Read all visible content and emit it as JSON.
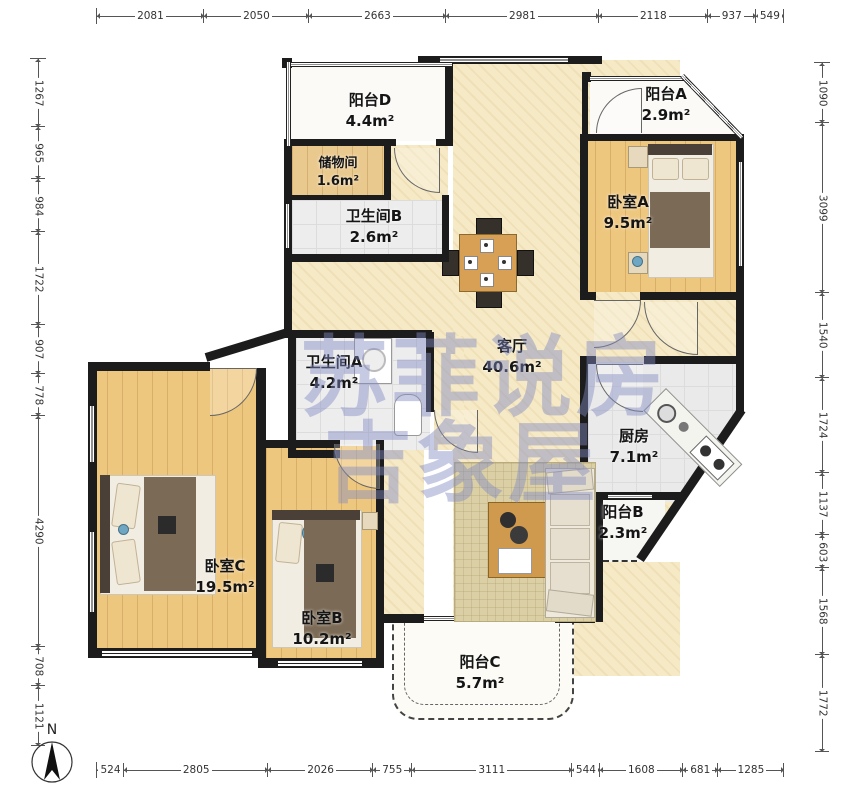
{
  "watermark": {
    "line1": "苏菲说房",
    "line2": "吉象屋"
  },
  "compass": {
    "label": "N"
  },
  "dimensions": {
    "top": [
      2081,
      2050,
      2663,
      2981,
      2118,
      937,
      549
    ],
    "bottom": [
      524,
      2805,
      2026,
      755,
      3111,
      544,
      1608,
      681,
      1285
    ],
    "left": [
      1267,
      965,
      984,
      1722,
      907,
      778,
      4290,
      708,
      1121
    ],
    "right": [
      1090,
      3099,
      1540,
      1724,
      1137,
      603,
      1568,
      1772
    ]
  },
  "rooms": {
    "balcony_d": {
      "name": "阳台D",
      "area": "4.4m²"
    },
    "storage": {
      "name": "储物间",
      "area": "1.6m²"
    },
    "bathroom_b": {
      "name": "卫生间B",
      "area": "2.6m²"
    },
    "balcony_a": {
      "name": "阳台A",
      "area": "2.9m²"
    },
    "bedroom_a": {
      "name": "卧室A",
      "area": "9.5m²"
    },
    "living_room": {
      "name": "客厅",
      "area": "40.6m²"
    },
    "bathroom_a": {
      "name": "卫生间A",
      "area": "4.2m²"
    },
    "kitchen": {
      "name": "厨房",
      "area": "7.1m²"
    },
    "balcony_b": {
      "name": "阳台B",
      "area": "2.3m²"
    },
    "bedroom_c": {
      "name": "卧室C",
      "area": "19.5m²"
    },
    "bedroom_b": {
      "name": "卧室B",
      "area": "10.2m²"
    },
    "balcony_c": {
      "name": "阳台C",
      "area": "5.7m²"
    }
  },
  "colors": {
    "wall": "#1c1c1c",
    "wood_floor": "#eec77f",
    "living_floor": "#f5e9c6",
    "tile": "#ededee",
    "watermark": "#808ac1"
  }
}
